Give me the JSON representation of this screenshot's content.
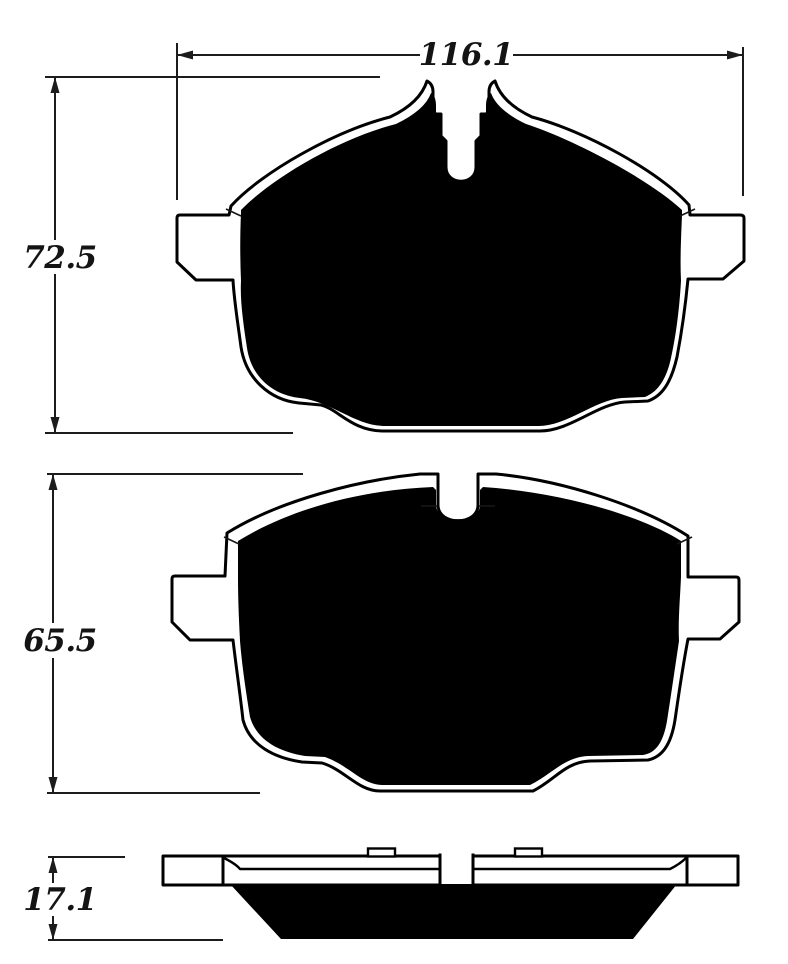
{
  "drawing": {
    "kind": "brake-pad-dimension-diagram",
    "background": "#ffffff",
    "ink": "#000000",
    "dim_ink": "#1c1c1c",
    "views": {
      "pad_front_top": {
        "width_label": "116.1",
        "height_label": "72.5"
      },
      "pad_front_middle": {
        "height_label": "65.5"
      },
      "pad_side_profile": {
        "thickness_label": "17.1"
      }
    }
  }
}
